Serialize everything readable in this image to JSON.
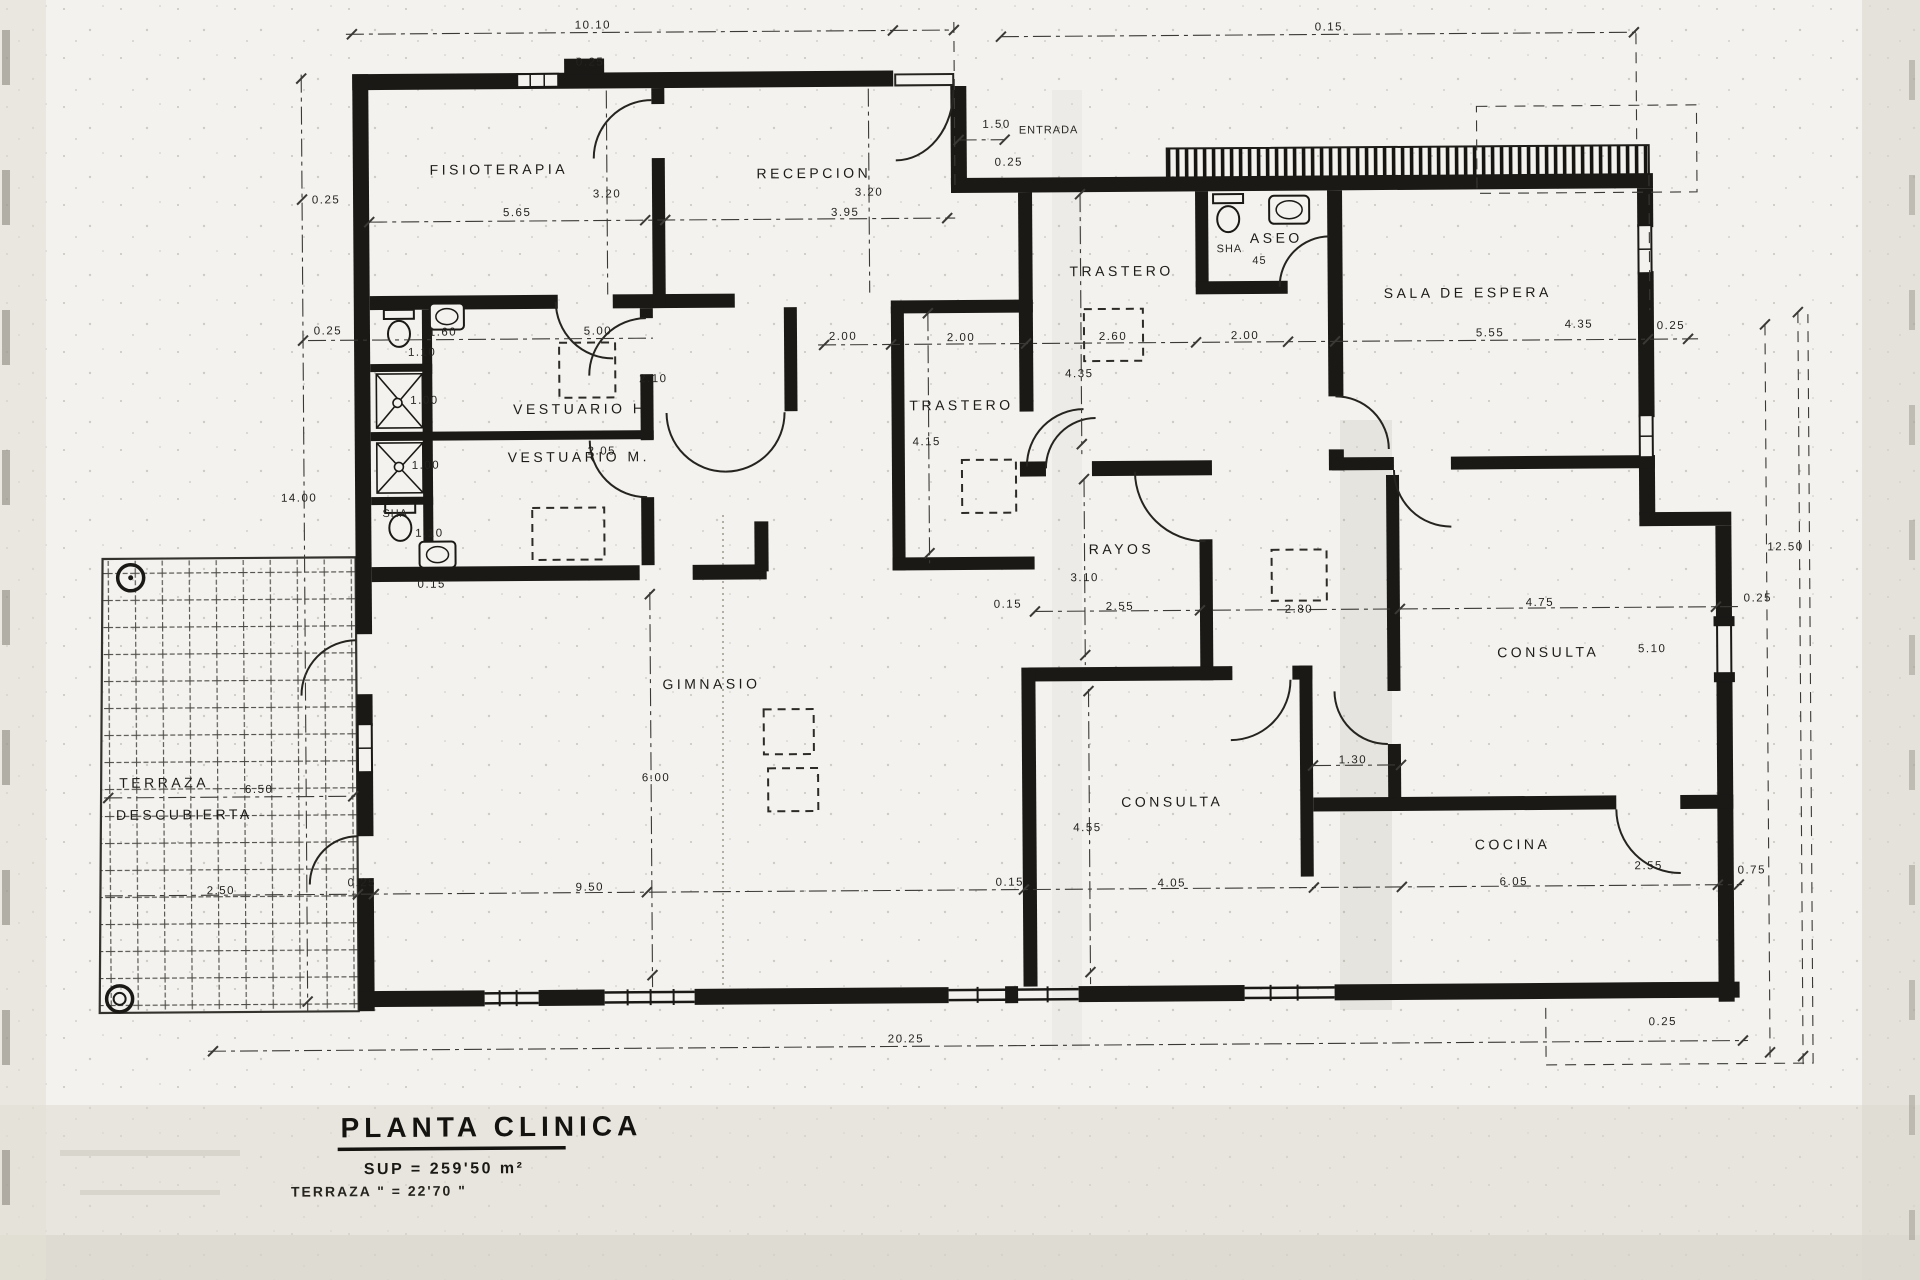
{
  "document": {
    "type": "scanned architectural floor plan",
    "ink_color": "#1a1916",
    "paper_color": "#f3f2ee"
  },
  "title_block": {
    "title": "PLANTA CLINICA",
    "area_line": "SUP  =  259'50 m²",
    "terrace_line": "TERRAZA  \"   =   22'70  \""
  },
  "plan": {
    "rooms": [
      {
        "label": "FISIOTERAPIA",
        "x": 502,
        "y": 171
      },
      {
        "label": "RECEPCION",
        "x": 817,
        "y": 177
      },
      {
        "label": "TRASTERO",
        "x": 1124,
        "y": 277
      },
      {
        "label": "ASEO",
        "x": 1279,
        "y": 245
      },
      {
        "label": "SALA DE ESPERA",
        "x": 1470,
        "y": 301
      },
      {
        "label": "VESTUARIO H.",
        "x": 585,
        "y": 411
      },
      {
        "label": "VESTUARIO M.",
        "x": 580,
        "y": 459
      },
      {
        "label": "TRASTERO",
        "x": 963,
        "y": 410
      },
      {
        "label": "RAYOS",
        "x": 1122,
        "y": 555
      },
      {
        "label": "GIMNASIO",
        "x": 711,
        "y": 687
      },
      {
        "label": "CONSULTA",
        "x": 1171,
        "y": 808
      },
      {
        "label": "CONSULTA",
        "x": 1548,
        "y": 661
      },
      {
        "label": "COCINA",
        "x": 1511,
        "y": 853
      },
      {
        "label": "TERRAZA",
        "x": 163,
        "y": 782
      },
      {
        "label": "DESCUBIERTA",
        "x": 183,
        "y": 814
      }
    ],
    "dimensions": [
      {
        "label": "10.10",
        "x": 597,
        "y": 26
      },
      {
        "label": "0.25",
        "x": 594,
        "y": 63
      },
      {
        "label": "0.15",
        "x": 1333,
        "y": 33
      },
      {
        "label": "1.50",
        "x": 1000,
        "y": 128
      },
      {
        "label": "0.25",
        "x": 1012,
        "y": 166
      },
      {
        "label": "0.25",
        "x": 329,
        "y": 199
      },
      {
        "label": "0.25",
        "x": 330,
        "y": 330
      },
      {
        "label": "14.00",
        "x": 300,
        "y": 497
      },
      {
        "label": "3.20",
        "x": 610,
        "y": 195
      },
      {
        "label": "5.65",
        "x": 520,
        "y": 213
      },
      {
        "label": "3.20",
        "x": 872,
        "y": 195
      },
      {
        "label": "3.95",
        "x": 848,
        "y": 215
      },
      {
        "label": "5.00",
        "x": 600,
        "y": 332
      },
      {
        "label": "2.10",
        "x": 655,
        "y": 380
      },
      {
        "label": "2.05",
        "x": 603,
        "y": 452
      },
      {
        "label": "1.60",
        "x": 445,
        "y": 332
      },
      {
        "label": "1.10",
        "x": 424,
        "y": 352
      },
      {
        "label": "1.00",
        "x": 426,
        "y": 400
      },
      {
        "label": "1.00",
        "x": 427,
        "y": 465
      },
      {
        "label": "1.10",
        "x": 430,
        "y": 533
      },
      {
        "label": "2.00",
        "x": 845,
        "y": 339
      },
      {
        "label": "2.00",
        "x": 963,
        "y": 341
      },
      {
        "label": "4.15",
        "x": 928,
        "y": 445
      },
      {
        "label": "2.60",
        "x": 1115,
        "y": 341
      },
      {
        "label": "4.35",
        "x": 1081,
        "y": 378
      },
      {
        "label": "2.00",
        "x": 1247,
        "y": 341
      },
      {
        "label": "5.55",
        "x": 1492,
        "y": 340
      },
      {
        "label": "4.35",
        "x": 1581,
        "y": 332
      },
      {
        "label": "0.25",
        "x": 1673,
        "y": 334
      },
      {
        "label": "12.50",
        "x": 1786,
        "y": 556
      },
      {
        "label": "3.10",
        "x": 1085,
        "y": 582
      },
      {
        "label": "2.55",
        "x": 1120,
        "y": 611
      },
      {
        "label": "0.15",
        "x": 1008,
        "y": 608
      },
      {
        "label": "2.80",
        "x": 1299,
        "y": 615
      },
      {
        "label": "4.75",
        "x": 1540,
        "y": 610
      },
      {
        "label": "5.10",
        "x": 1652,
        "y": 657
      },
      {
        "label": "0.25",
        "x": 1758,
        "y": 607
      },
      {
        "label": "6.00",
        "x": 655,
        "y": 779
      },
      {
        "label": "0.15",
        "x": 432,
        "y": 584
      },
      {
        "label": "4.55",
        "x": 1086,
        "y": 832
      },
      {
        "label": "1.30",
        "x": 1352,
        "y": 766
      },
      {
        "label": "4.05",
        "x": 1170,
        "y": 888
      },
      {
        "label": "0.15",
        "x": 1008,
        "y": 886
      },
      {
        "label": "6.05",
        "x": 1512,
        "y": 889
      },
      {
        "label": "2.55",
        "x": 1647,
        "y": 874
      },
      {
        "label": "0.75",
        "x": 1750,
        "y": 879
      },
      {
        "label": "9.50",
        "x": 588,
        "y": 888
      },
      {
        "label": "0.25",
        "x": 360,
        "y": 882
      },
      {
        "label": "6.50",
        "x": 258,
        "y": 788
      },
      {
        "label": "2.50",
        "x": 219,
        "y": 889
      },
      {
        "label": "20.25",
        "x": 903,
        "y": 1042
      },
      {
        "label": "0.25",
        "x": 1660,
        "y": 1030
      }
    ],
    "annotations": [
      {
        "label": "ENTRADA",
        "x": 1052,
        "y": 134
      },
      {
        "label": "SHA",
        "x": 1232,
        "y": 254
      },
      {
        "label": "45",
        "x": 1262,
        "y": 266
      },
      {
        "label": "SHA",
        "x": 396,
        "y": 513
      }
    ]
  }
}
